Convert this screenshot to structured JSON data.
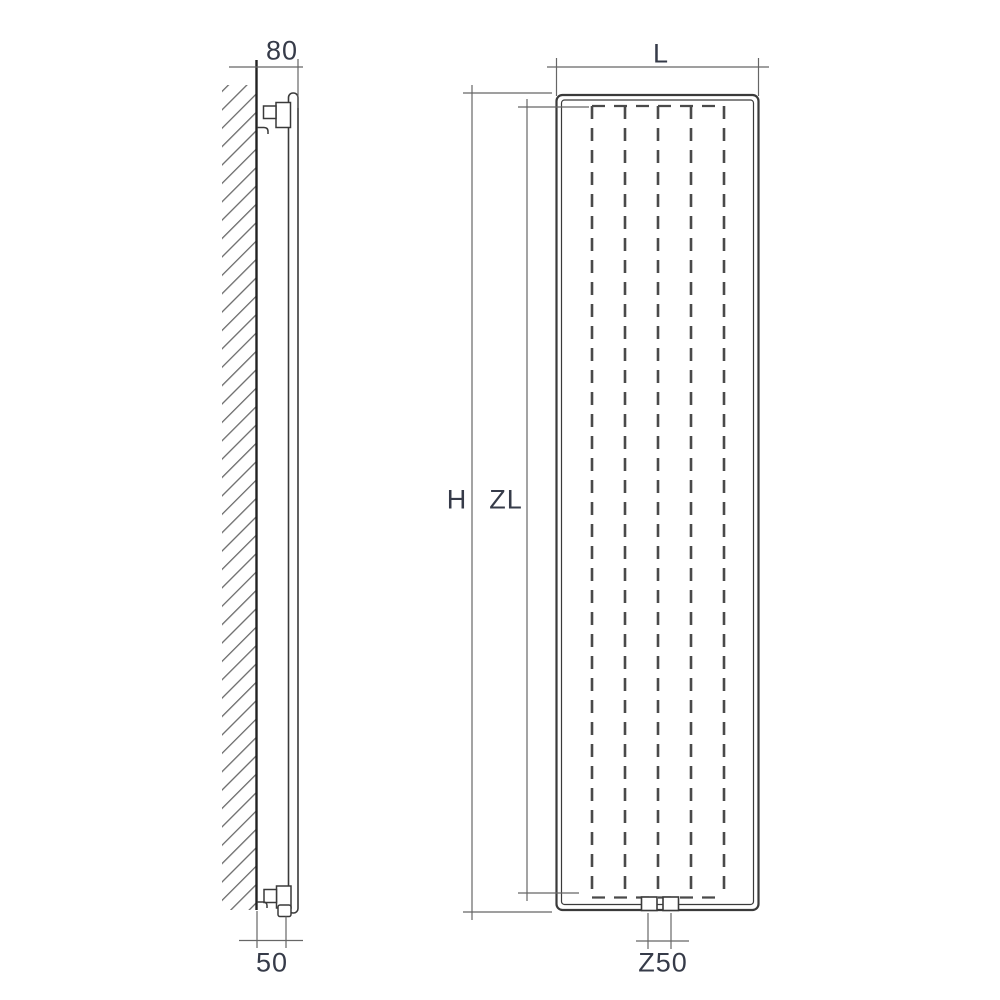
{
  "dimensions": {
    "depth": "80",
    "pipe_offset": "50",
    "width": "L",
    "height": "H",
    "panel_height": "ZL",
    "connection_spacing": "Z50"
  },
  "colors": {
    "background": "#ffffff",
    "outline": "#3a3a3a",
    "wall_line": "#222222",
    "dimension_line": "#666666",
    "hatch_line": "#6a6a6a",
    "fin_dash": "#4a4a4a",
    "label_text": "#363b49"
  }
}
